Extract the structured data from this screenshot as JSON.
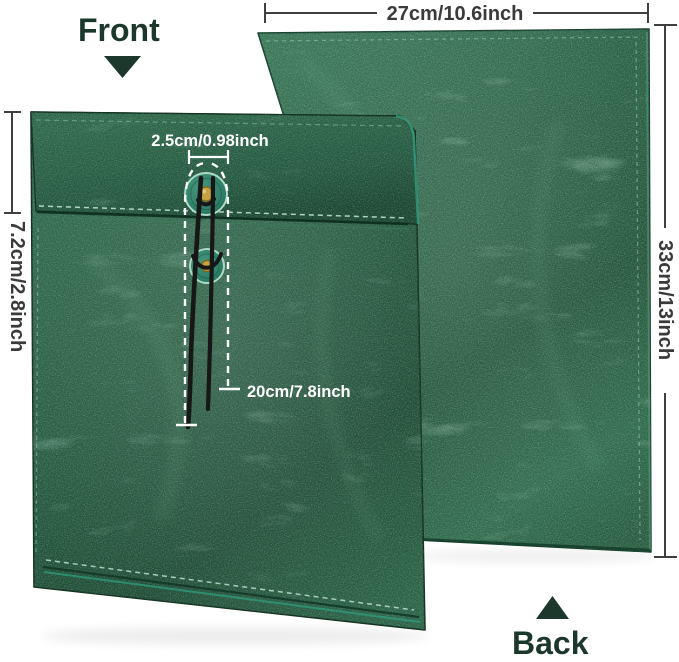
{
  "labels": {
    "front": "Front",
    "back": "Back"
  },
  "dimensions": {
    "width": "27cm/10.6inch",
    "height": "33cm/13inch",
    "flap_depth": "7.2cm/2.8inch",
    "button_diameter": "2.5cm/0.98inch",
    "string_length": "20cm/7.8inch"
  },
  "colors": {
    "background": "#ffffff",
    "leather_green_dark": "#1c4a33",
    "leather_green": "#2b6448",
    "leather_green_light": "#4d8a6c",
    "stitch_teal": "#bfe0d0",
    "piping_teal": "#2fa285",
    "button_teal": "#2e7f68",
    "grommet_gold": "#c7a243",
    "cord_black": "#171717",
    "annotation_white": "#ffffff",
    "dimension_line_gray": "#3f3f3f",
    "label_dark_green": "#1c382c"
  }
}
